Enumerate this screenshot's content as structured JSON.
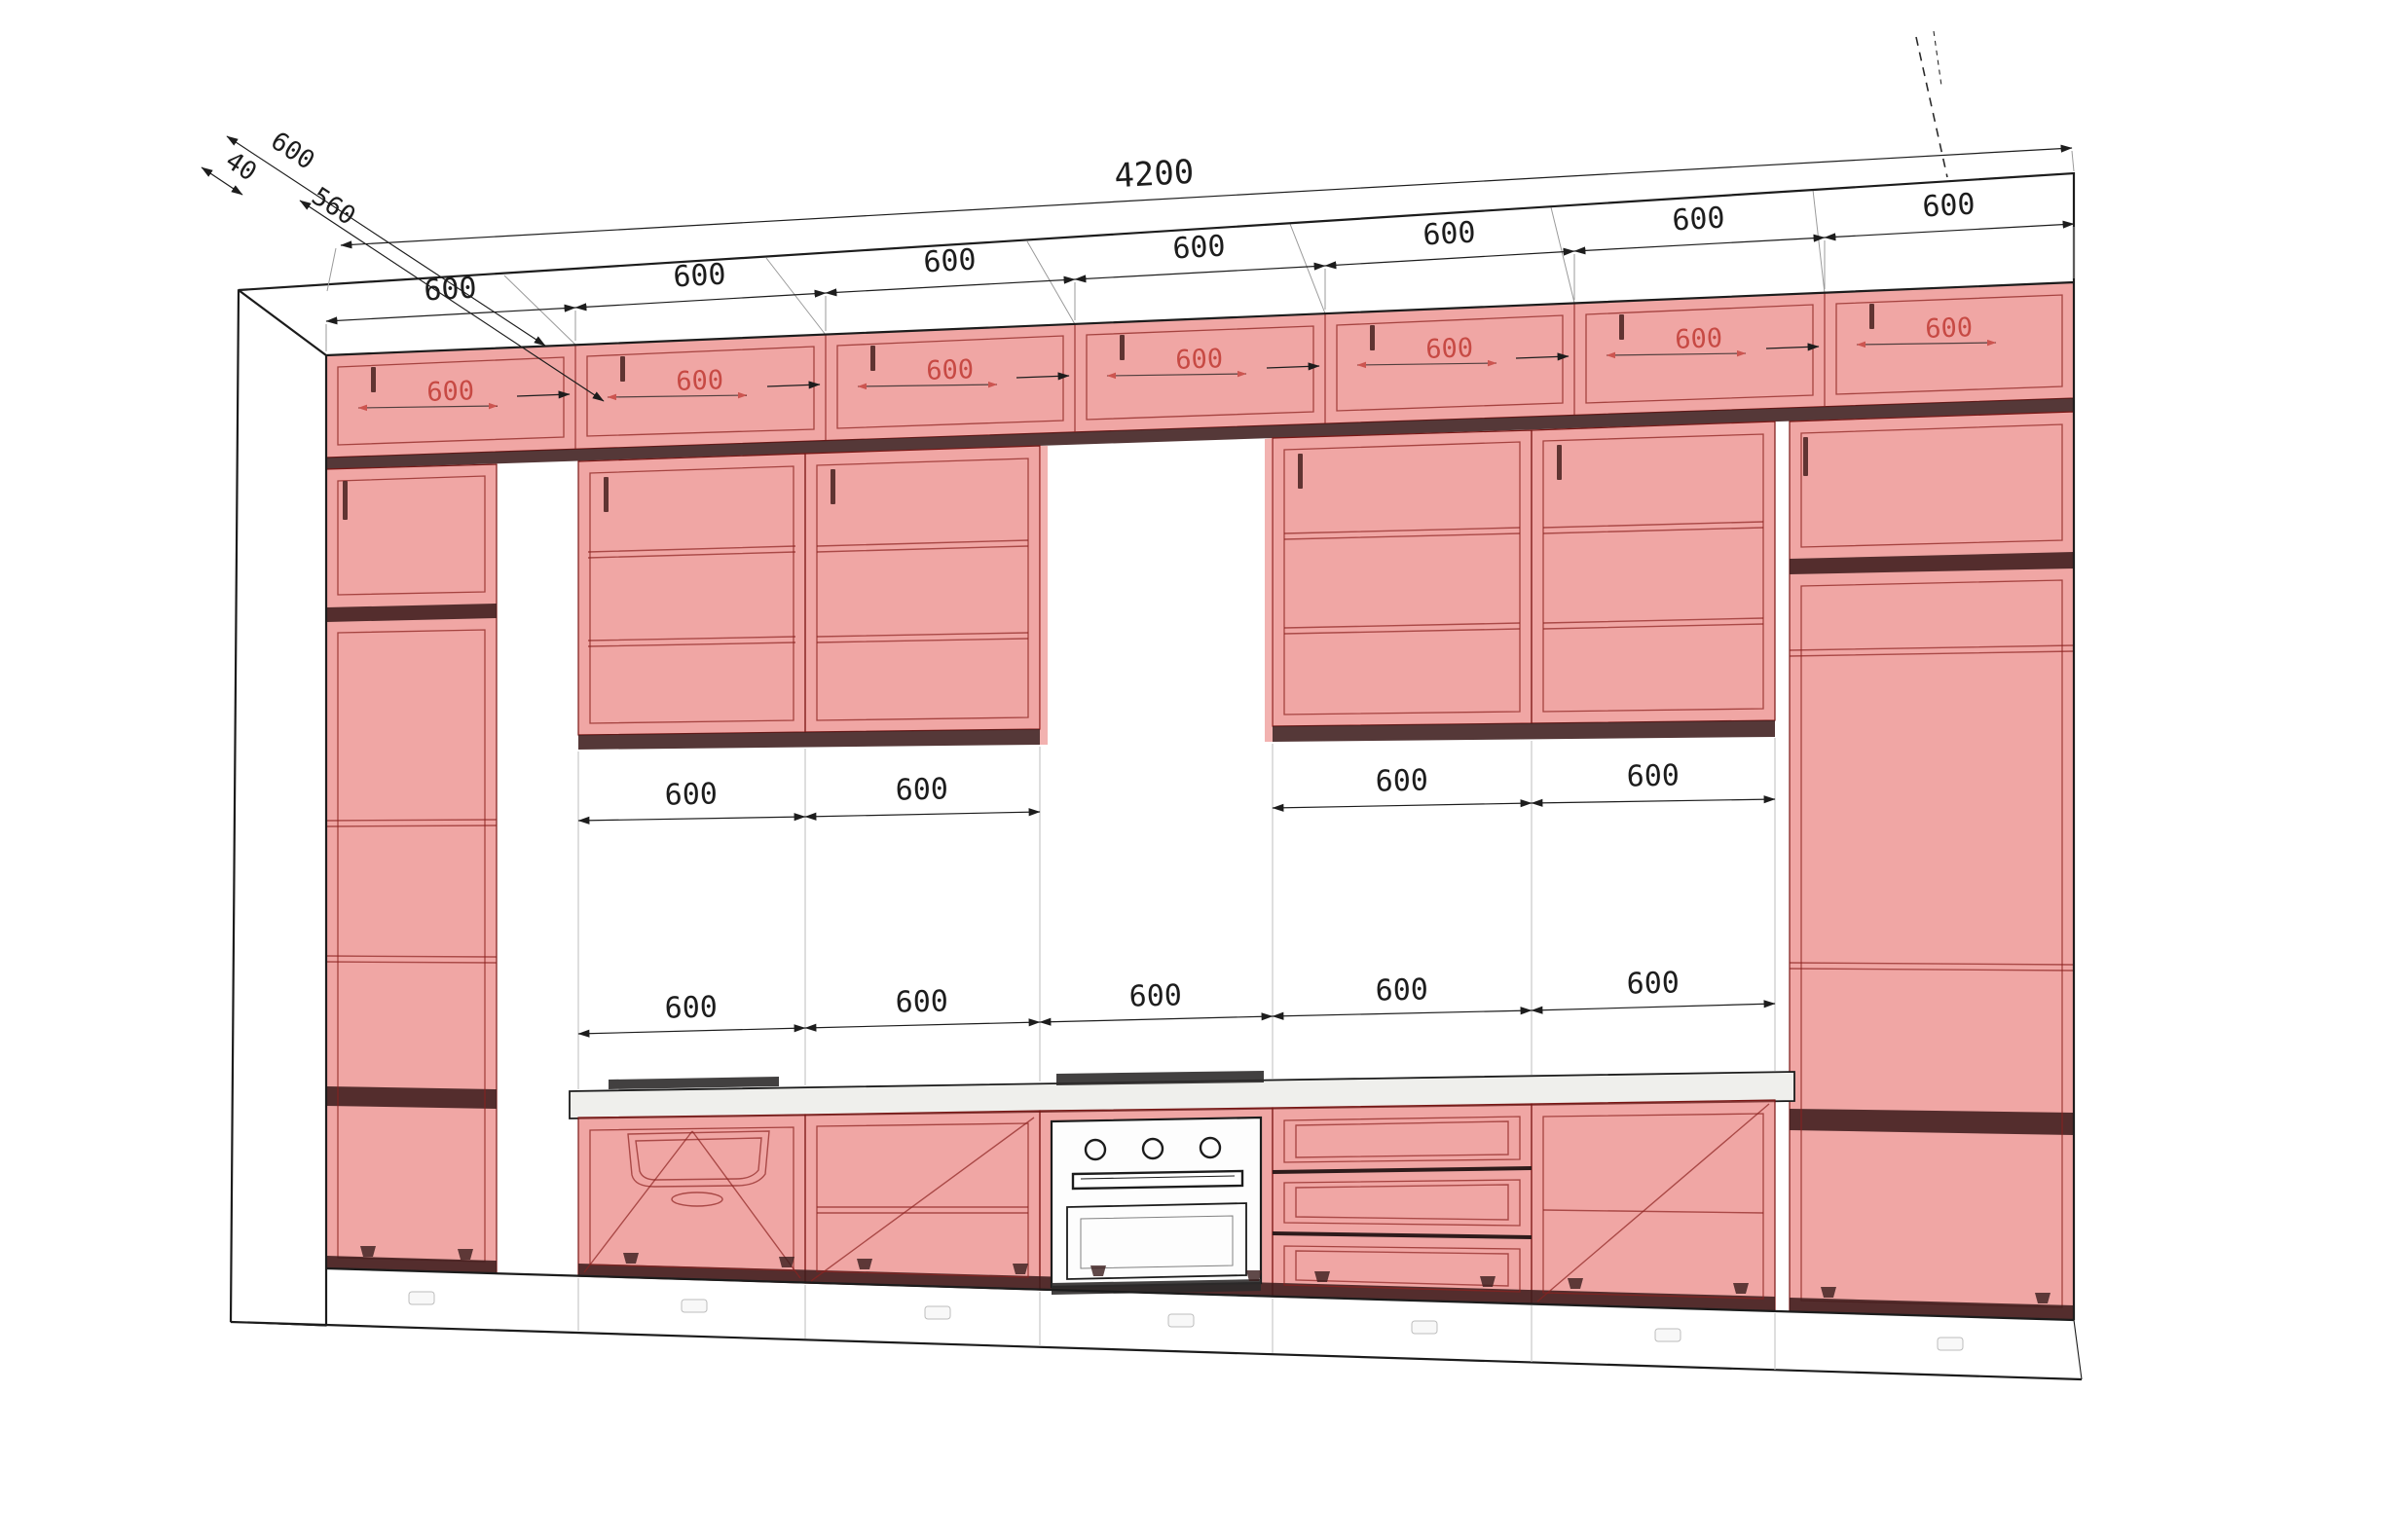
{
  "diagram": {
    "type": "kitchen-cabinet-elevation-3d-wireframe",
    "units": "mm"
  },
  "dimensions": {
    "total_width": "4200",
    "top_segments": [
      "600",
      "600",
      "600",
      "600",
      "600",
      "600",
      "600"
    ],
    "depth_top": "600",
    "depth_overhang": "40",
    "depth_carcass": "560",
    "upper_backsplash_segments": [
      "600",
      "600",
      "600",
      "600"
    ],
    "lower_backsplash_segments": [
      "600",
      "600",
      "600",
      "600",
      "600"
    ],
    "cabinet_internal_widths": [
      "600",
      "600",
      "600",
      "600",
      "600",
      "600",
      "600"
    ]
  },
  "colors": {
    "cabinet_fill": "#e25550",
    "cabinet_inner_line": "#8c221f",
    "carcass_band": "#3d1c1c",
    "outline": "#1c1c1c",
    "dimension_text": "#1d1d1d",
    "internal_dimension_text": "#c03a34",
    "countertop": "#efefec",
    "background": "#ffffff"
  }
}
